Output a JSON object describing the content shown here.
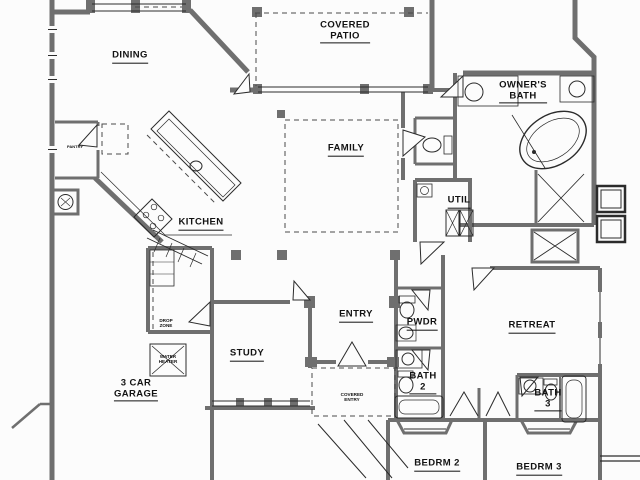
{
  "plan": {
    "type": "residential-floor-plan",
    "labels": {
      "dining": "DINING",
      "covered_patio_l1": "COVERED",
      "covered_patio_l2": "PATIO",
      "owners_bath_l1": "OWNER'S",
      "owners_bath_l2": "BATH",
      "family": "FAMILY",
      "kitchen": "KITCHEN",
      "pantry": "PANTRY",
      "util": "UTIL",
      "entry": "ENTRY",
      "pwdr": "PWDR",
      "retreat": "RETREAT",
      "study": "STUDY",
      "bath2_l1": "BATH",
      "bath2_l2": "2",
      "bath3_l1": "BATH",
      "bath3_l2": "3",
      "garage_l1": "3 CAR",
      "garage_l2": "GARAGE",
      "drop_zone_l1": "DROP",
      "drop_zone_l2": "ZONE",
      "water_heater_l1": "WATER",
      "water_heater_l2": "HEATER",
      "covered_entry_l1": "COVERED",
      "covered_entry_l2": "ENTRY",
      "bedrm2": "BEDRM 2",
      "bedrm3": "BEDRM 3"
    },
    "colors": {
      "wall": "#6f6f6f",
      "line": "#2b2b2b",
      "background": "#fcfcfc"
    }
  }
}
